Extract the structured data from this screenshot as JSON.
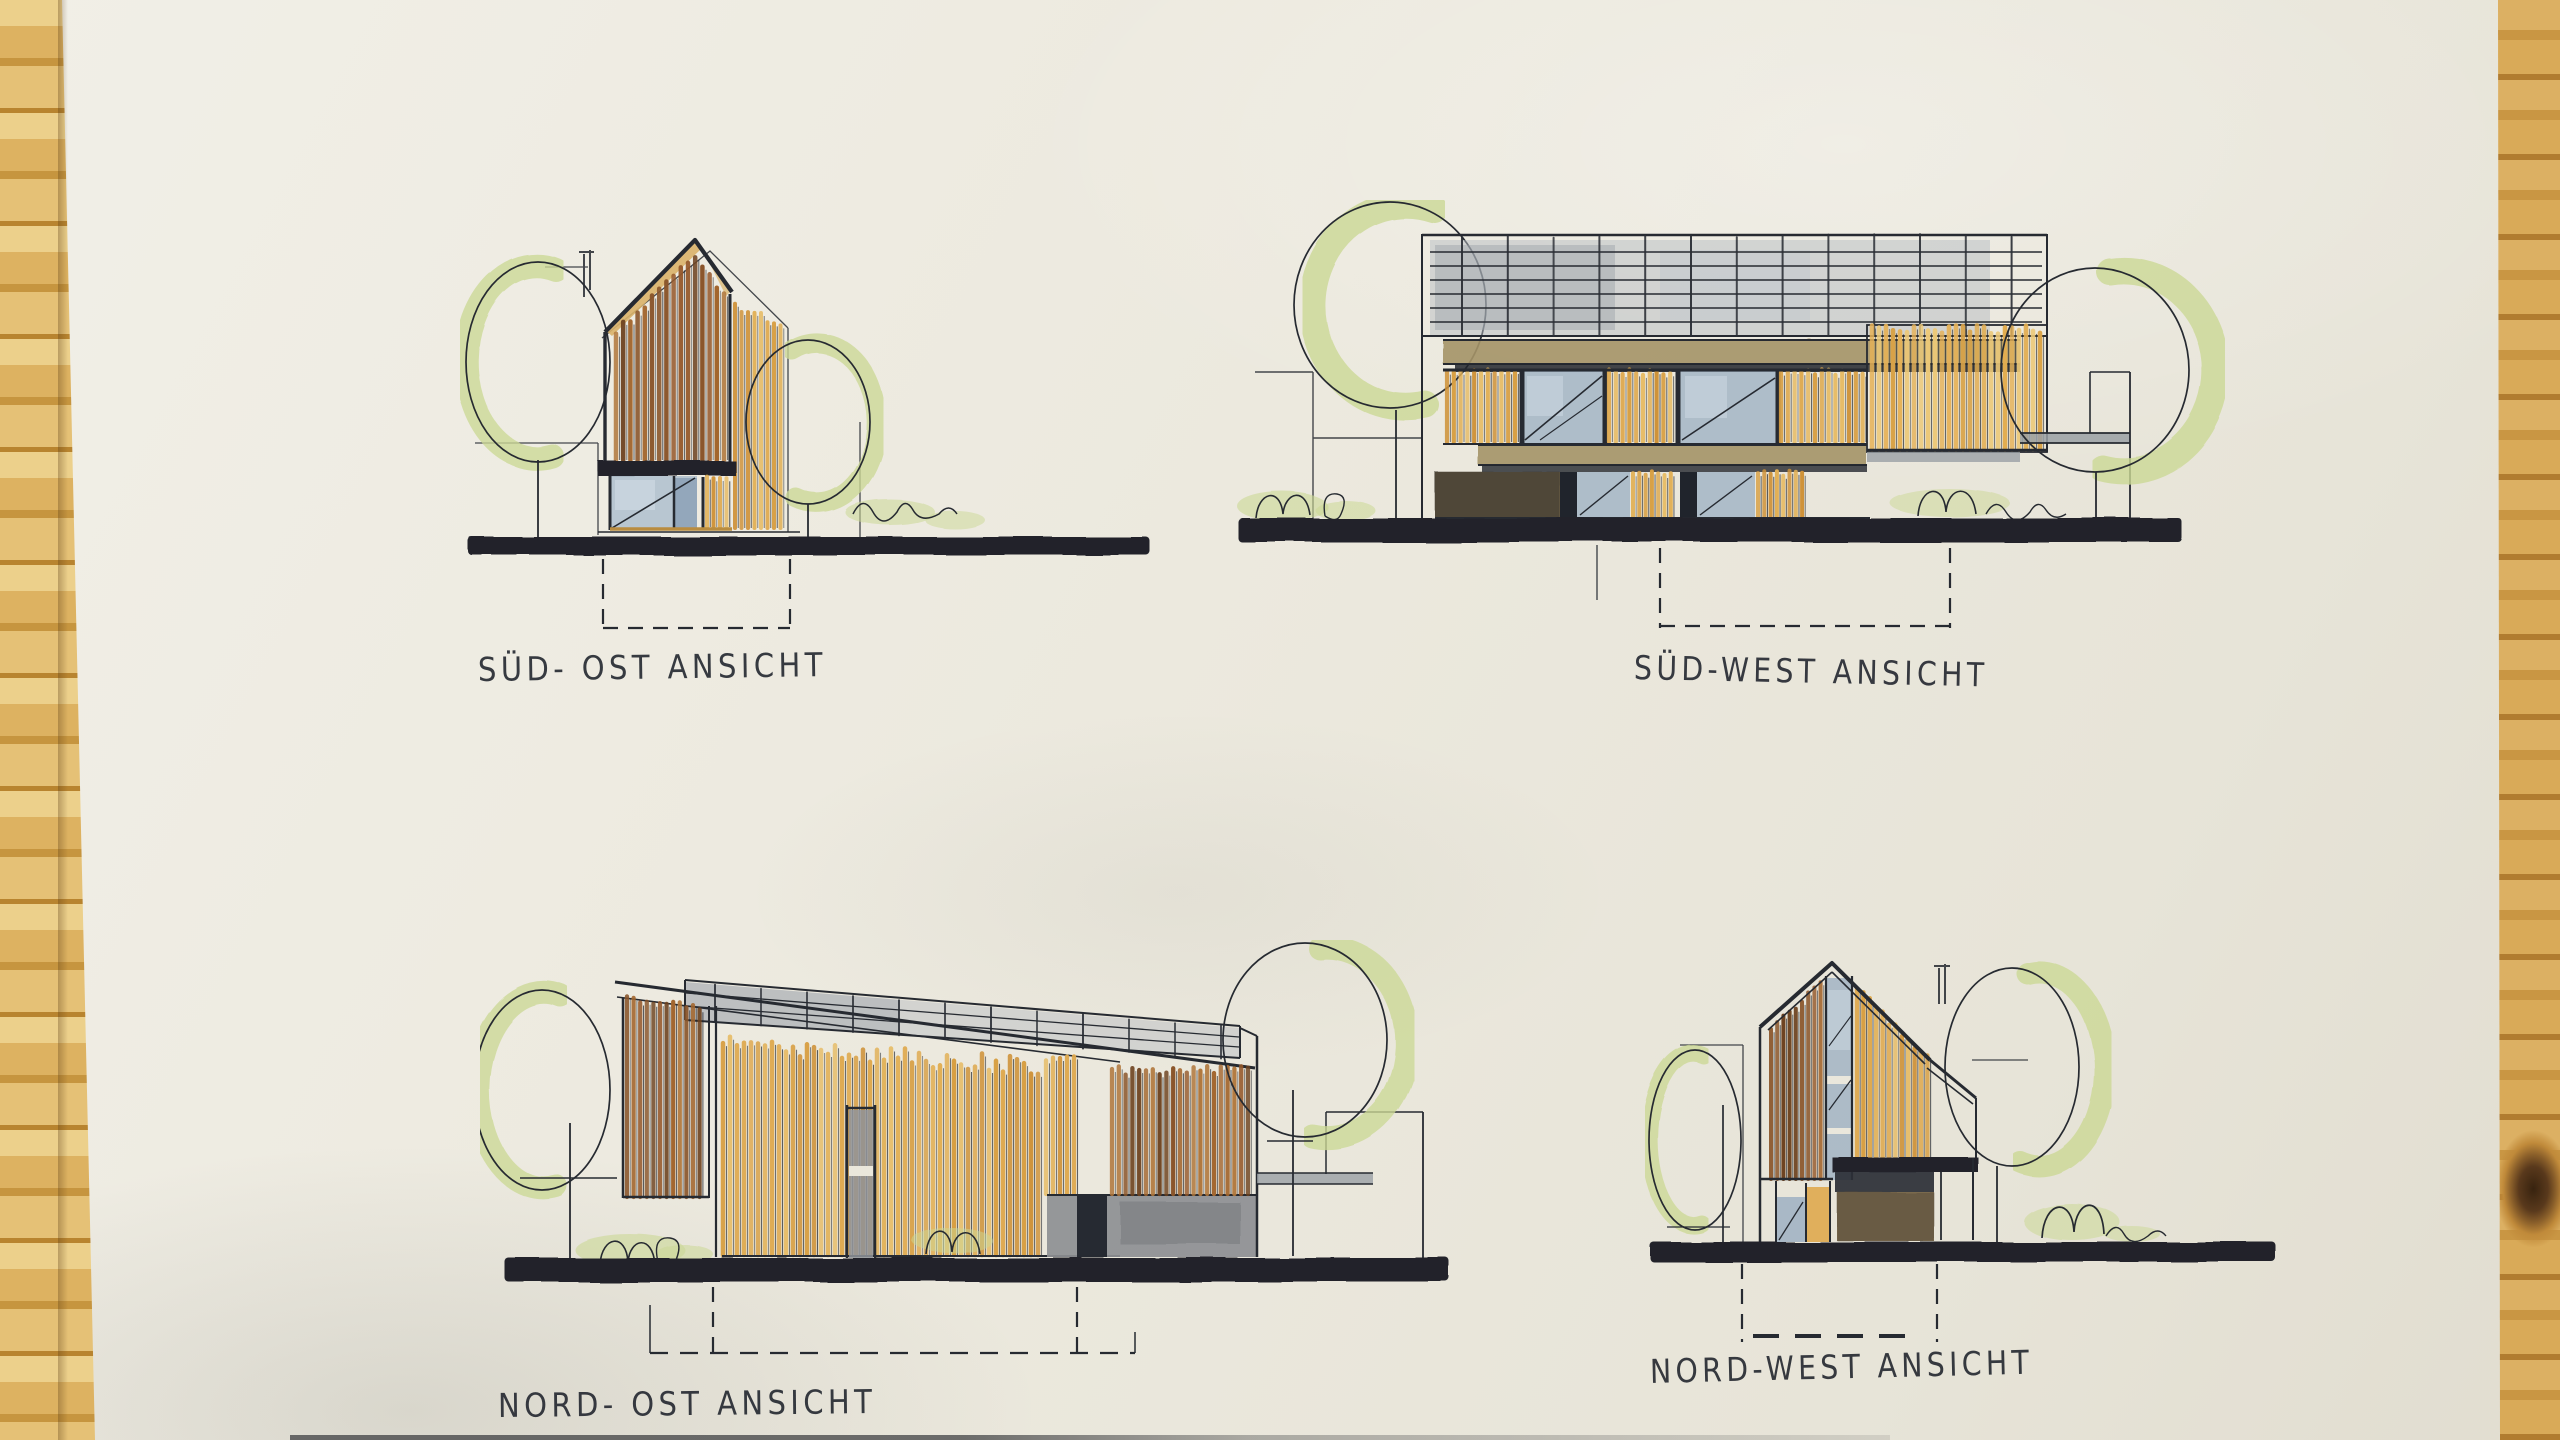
{
  "sheet": {
    "drawings": [
      {
        "id": "sued-ost",
        "label": "SÜD- OST ANSICHT"
      },
      {
        "id": "sued-west",
        "label": "SÜD-WEST ANSICHT"
      },
      {
        "id": "nord-ost",
        "label": "NORD- OST ANSICHT"
      },
      {
        "id": "nord-west",
        "label": "NORD-WEST ANSICHT"
      }
    ]
  },
  "palette": {
    "ink": "#262a31",
    "ground_ink": "#20242c",
    "paper": "#eae7dc",
    "wood_table": "#d3a251",
    "foliage_green": "#ccd996",
    "glass_blue": "#9db0c2",
    "railing_gray": "#b6bbc1",
    "slab_tan": "#a59467",
    "concrete_gray": "#8d8f92",
    "fascia_tan": "#d9b36a",
    "dark_wall_brown": "#5f543f"
  },
  "slat_palettes": {
    "rust": [
      "#8a552a",
      "#a3662e",
      "#6e4320",
      "#b0763a",
      "#95582a"
    ],
    "tan": [
      "#dfa94e",
      "#e7bc66",
      "#cf9238",
      "#e2b055",
      "#d89f42"
    ],
    "pale_tan": [
      "#e6b258",
      "#edc978",
      "#d9a348",
      "#e2ad50"
    ],
    "ink_post": [
      "#2a2e35"
    ]
  }
}
